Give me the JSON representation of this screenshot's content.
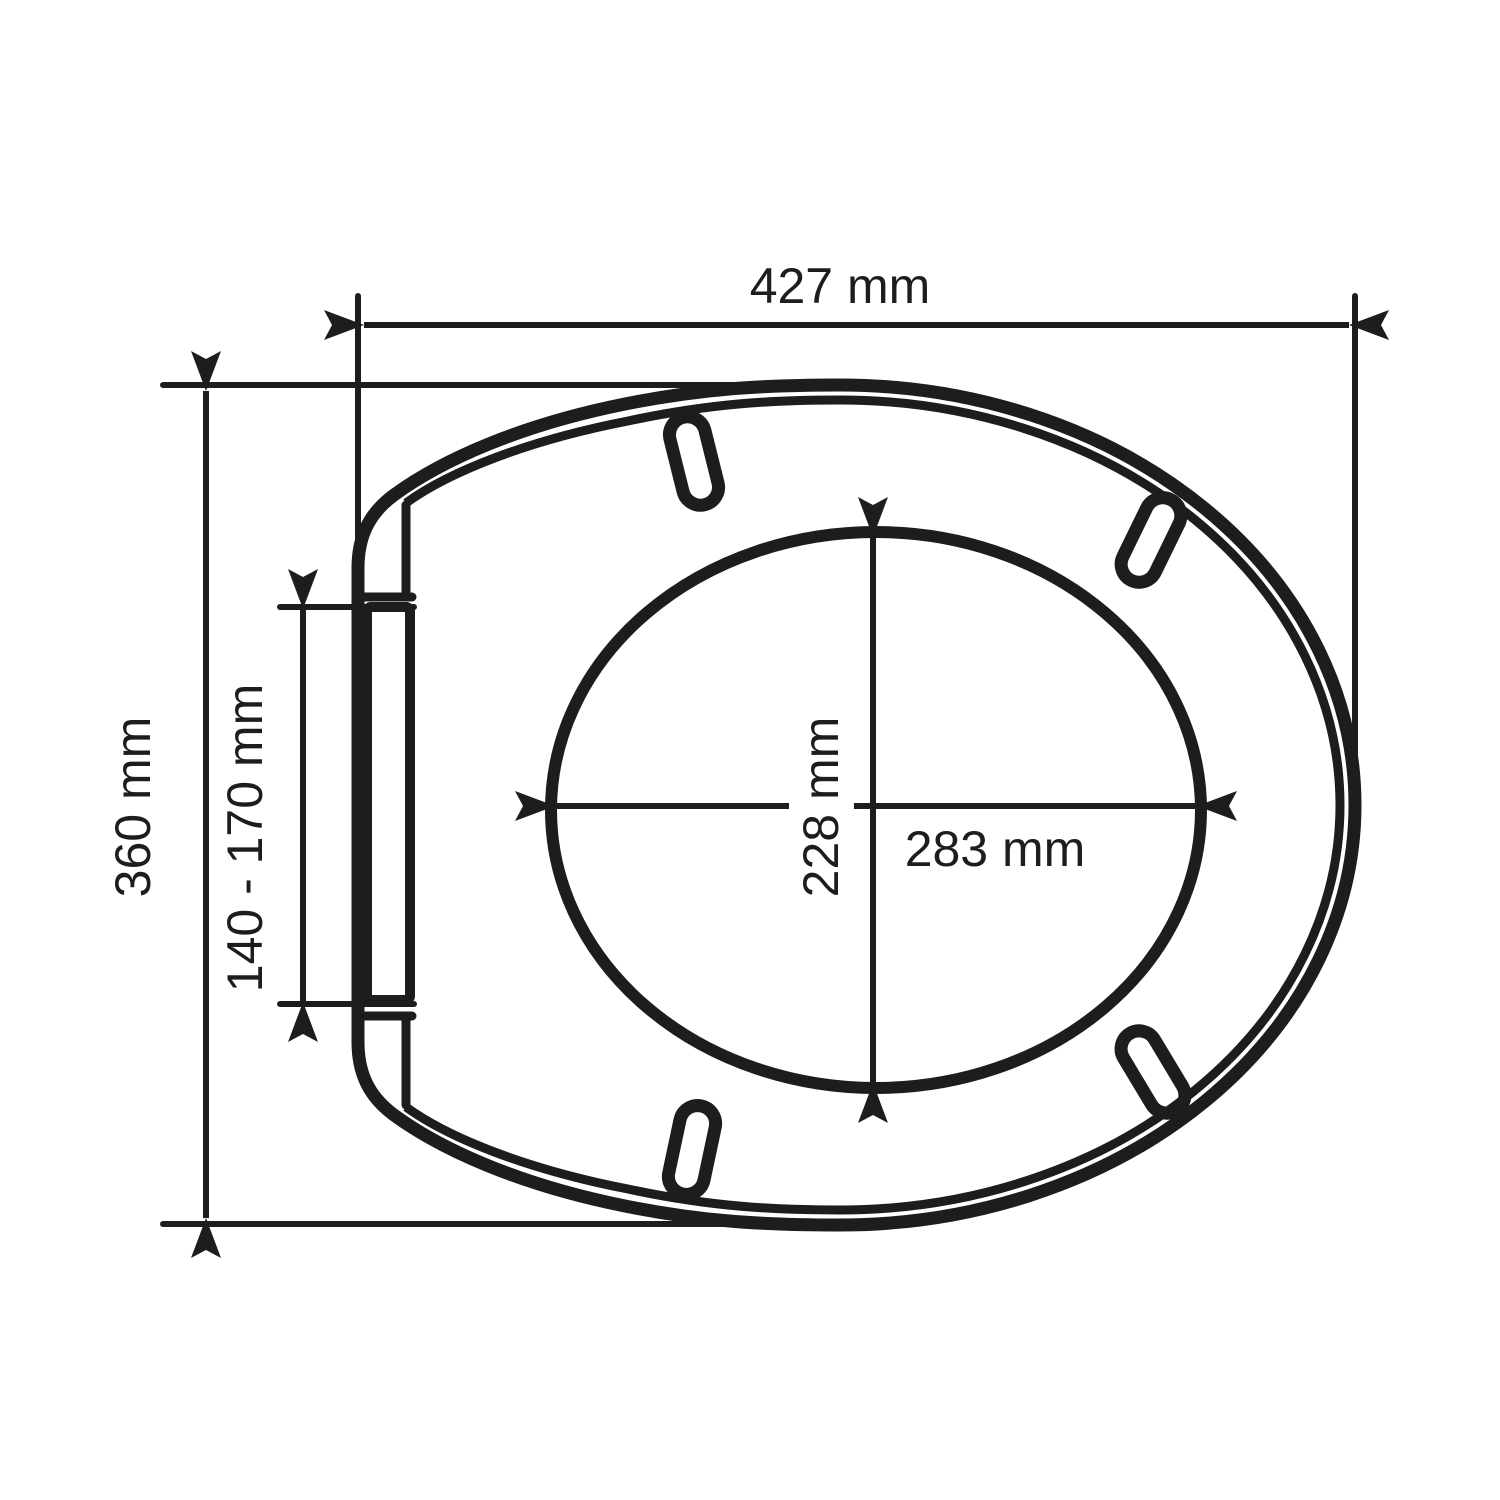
{
  "page": {
    "background": "#ffffff"
  },
  "diagram": {
    "type": "technical-dimension-drawing",
    "subject": "toilet seat top view",
    "line_color": "#1d1d1b",
    "labels": {
      "overall_width": "427 mm",
      "overall_depth": "360 mm",
      "hinge_adjustment_range": "140 - 170 mm",
      "opening_width": "283 mm",
      "opening_depth": "228 mm"
    }
  }
}
